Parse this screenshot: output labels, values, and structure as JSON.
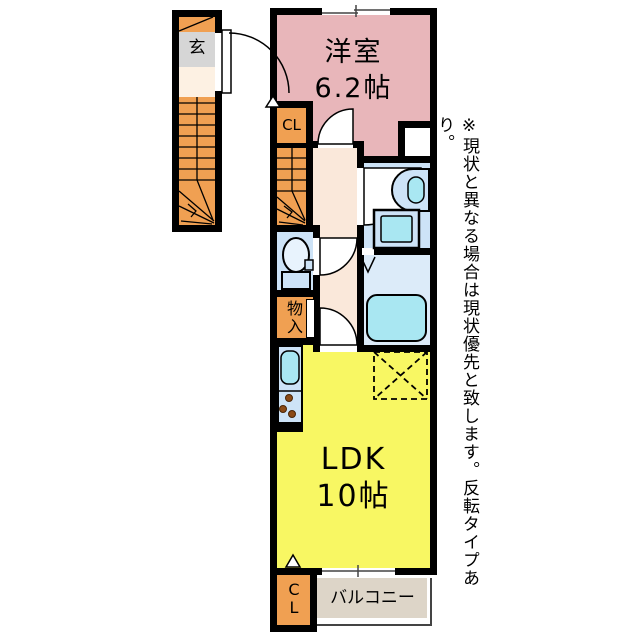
{
  "plan": {
    "rooms": {
      "western_room": {
        "label": "洋室",
        "size": "6.2帖"
      },
      "ldk": {
        "label": "LDK",
        "size": "10帖"
      },
      "entrance": {
        "label": "玄"
      },
      "closet_upper": {
        "label": "CL"
      },
      "closet_lower": {
        "char1": "C",
        "char2": "L"
      },
      "storage": {
        "char1": "物",
        "char2": "入"
      },
      "balcony": {
        "label": "バルコニー"
      }
    },
    "note": "※現状と異なる場合は現状優先と致します。反転タイプあり。",
    "colors": {
      "wall": "#000000",
      "western_room_pink": "#e8b6ba",
      "ldk_yellow": "#f8f763",
      "closet_orange": "#f0a052",
      "water_room_blue": "#cde3f7",
      "bathroom_blue": "#dcebf9",
      "fixture_cyan": "#a9e7f2",
      "hallway_cream": "#fae8da",
      "entrance_gray": "#d6d6d6",
      "landing_cream": "#fdf1e3",
      "balcony_beige": "#ddd5c8"
    }
  }
}
